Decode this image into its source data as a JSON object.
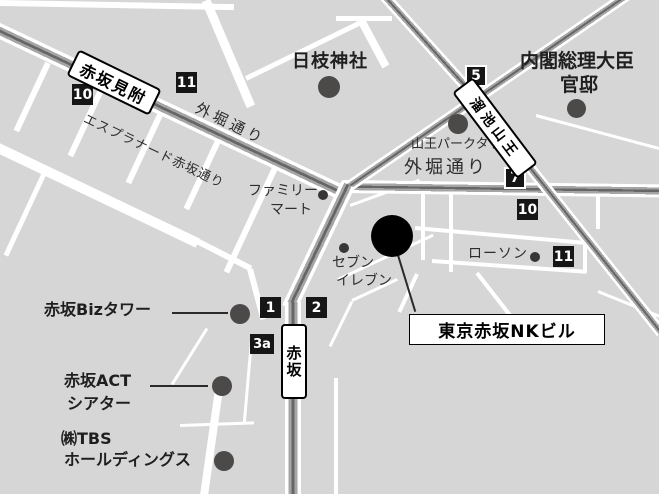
{
  "stations": {
    "akasaka_mitsuke": "赤坂見附",
    "tameike_sanno": "溜池山王",
    "akasaka": "赤坂"
  },
  "exits": {
    "mitsuke_10": "10",
    "mitsuke_11": "11",
    "tameike_5": "5",
    "tameike_7": "7",
    "tameike_10": "10",
    "tameike_11": "11",
    "akasaka_1": "1",
    "akasaka_2": "2",
    "akasaka_3a": "3a"
  },
  "roads": {
    "sotobori_dori_nw": "外堀通り",
    "esplanade_akasaka_dori": "エスプラナード赤坂通り",
    "sotobori_dori_east": "外堀通り"
  },
  "landmarks": {
    "hie_jinja": "日枝神社",
    "kantei_line1": "内閣総理大臣",
    "kantei_line2": "官邸",
    "sanno_park_tower": "山王パークタワー",
    "family_mart_line1": "ファミリー",
    "family_mart_line2": "マート",
    "seven_line1": "セブン",
    "seven_line2": "イレブン",
    "lawson": "ローソン",
    "akasaka_biz_tower": "赤坂Bizタワー",
    "act_line1": "赤坂ACT",
    "act_line2": "シアター",
    "tbs_line1": "㈱TBS",
    "tbs_line2": "ホールディングス"
  },
  "destination": {
    "name": "東京赤坂NKビル"
  },
  "colors": {
    "background": "#d6d6d6",
    "road_white": "#ffffff",
    "rail_gray": "#a5a5a5",
    "rail_dark": "#666666",
    "badge_black": "#161616",
    "landmark_dot": "#4c4949",
    "destination_black": "#000000"
  }
}
